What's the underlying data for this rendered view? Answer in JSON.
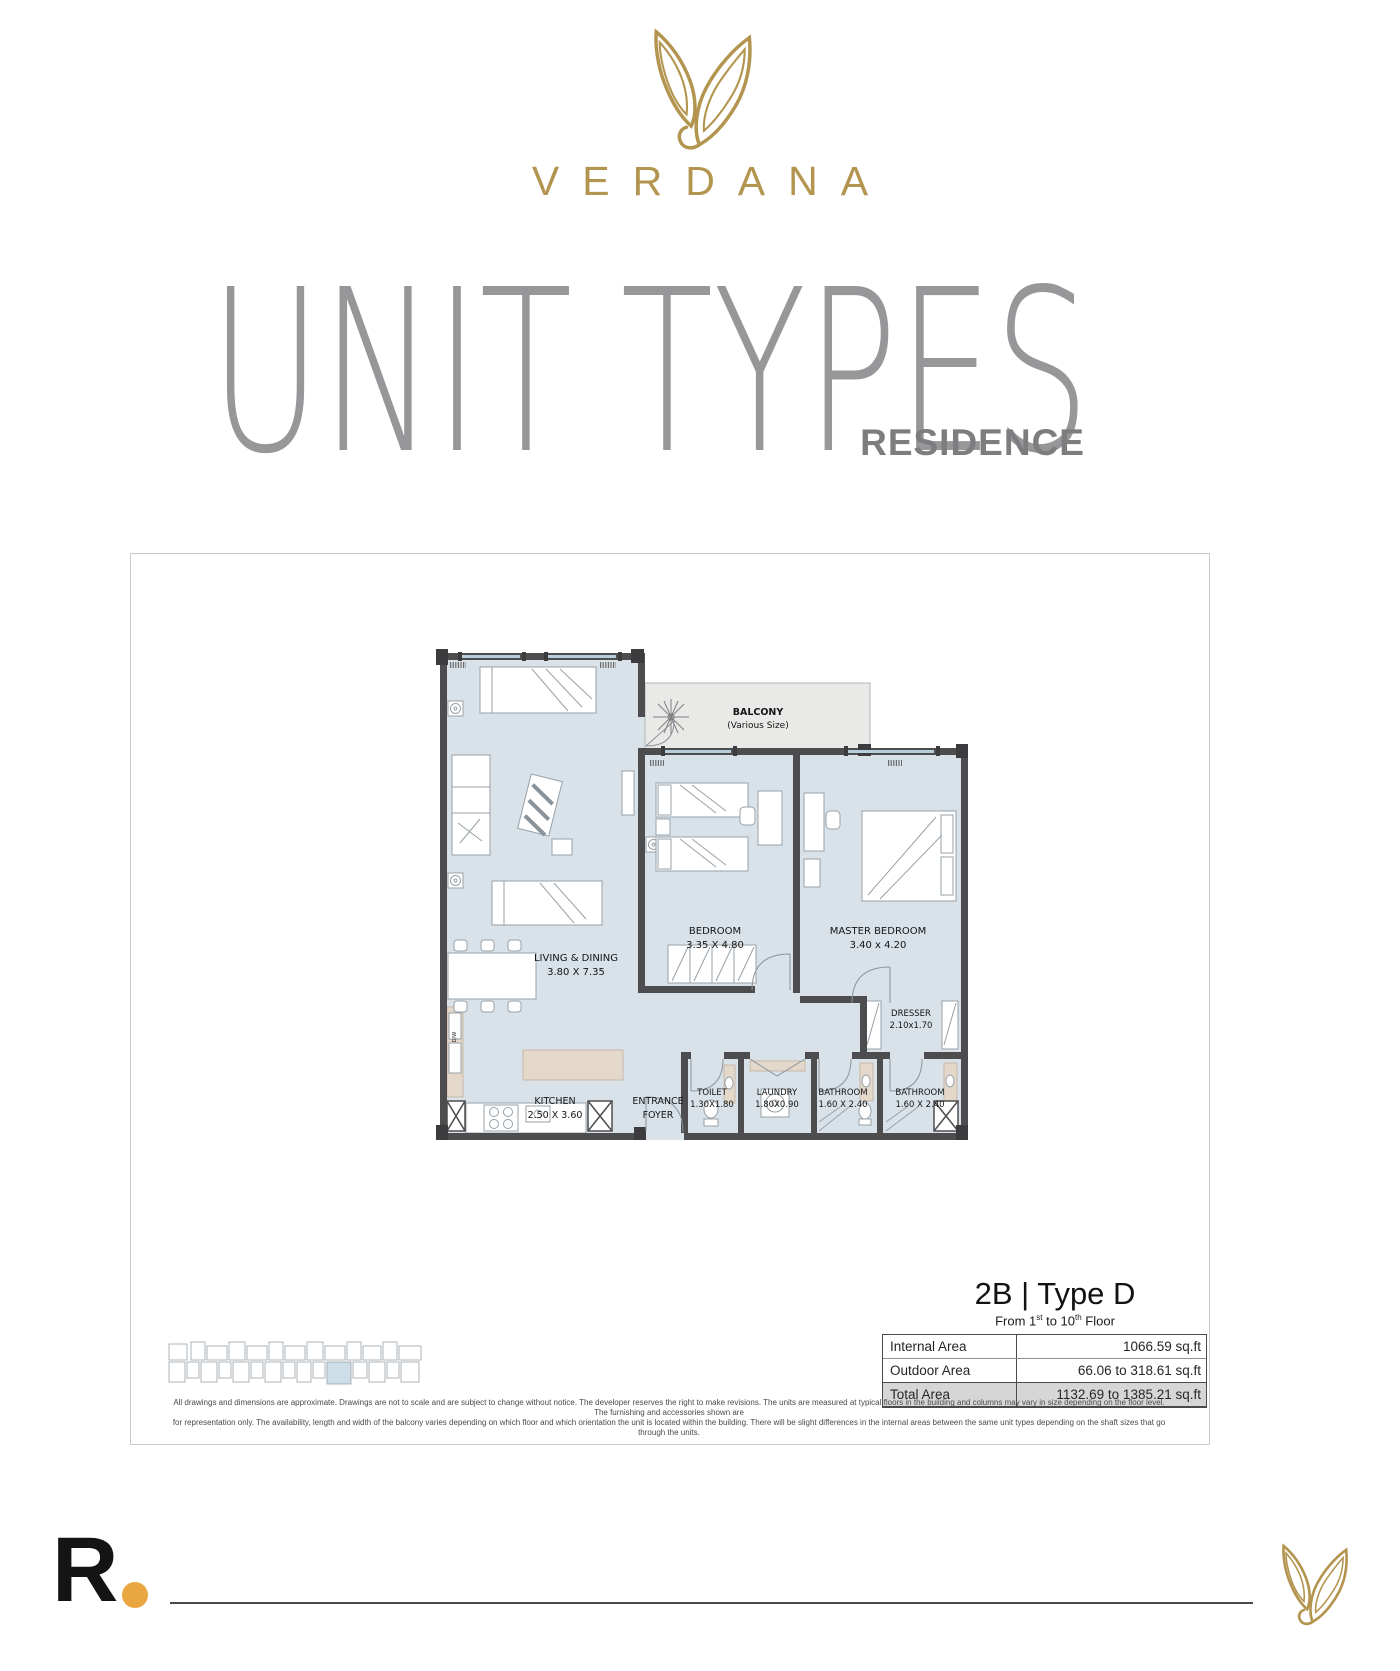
{
  "brand": {
    "name": "VERDANA"
  },
  "header": {
    "title": "UNIT TYPES",
    "subtitle": "RESIDENCE"
  },
  "unit": {
    "title": "2B | Type D",
    "floor_note": {
      "p1": "From 1",
      "s1": "st",
      "p2": " to 10",
      "s2": "th",
      "p3": " Floor"
    }
  },
  "floorplan": {
    "balcony": {
      "name": "BALCONY",
      "note": "(Various Size)"
    },
    "living": {
      "name": "LIVING & DINING",
      "dims": "3.80 X 7.35"
    },
    "bedroom": {
      "name": "BEDROOM",
      "dims": "3.35 X 4.80"
    },
    "master": {
      "name": "MASTER BEDROOM",
      "dims": "3.40 x 4.20"
    },
    "dresser": {
      "name": "DRESSER",
      "dims": "2.10x1.70"
    },
    "kitchen": {
      "name": "KITCHEN",
      "dims": "2.50 X 3.60"
    },
    "foyer": {
      "line1": "ENTRANCE",
      "line2": "FOYER"
    },
    "toilet": {
      "name": "TOILET",
      "dims": "1.30X1.80"
    },
    "laundry": {
      "name": "LAUNDRY",
      "dims": "1.80X0.90"
    },
    "bathroom1": {
      "name": "BATHROOM",
      "dims": "1.60 X 2.40"
    },
    "bathroom2": {
      "name": "BATHROOM",
      "dims": "1.60 X 2.40"
    },
    "dw": "D/W"
  },
  "area_table": {
    "rows": [
      {
        "label": "Internal Area",
        "value": "1066.59 sq.ft"
      },
      {
        "label": "Outdoor Area",
        "value": "66.06 to 318.61 sq.ft"
      },
      {
        "label": "Total Area",
        "value": "1132.69 to 1385.21 sq.ft"
      }
    ]
  },
  "disclaimer": {
    "line1": "All drawings and dimensions are approximate. Drawings are not to scale and are subject to change without notice. The developer reserves the right to make revisions. The units are measured at typical floors in the building and columns may vary in size depending on the floor level. The furnishing and accessories shown are",
    "line2": "for representation only. The availability, length and width of the balcony varies depending on which floor and which orientation the unit is located within the building. There will be slight differences in the internal areas between the same unit types depending on the shaft sizes that go through the units."
  },
  "footer": {
    "logo_letter": "R"
  },
  "colors": {
    "gold": "#b3954f",
    "accent_dot": "#eaa640",
    "room_fill": "#d9e2e9",
    "wall": "#4d4d4f",
    "balcony_fill": "#e9e9e7",
    "highlight_unit": "#cddee9"
  }
}
